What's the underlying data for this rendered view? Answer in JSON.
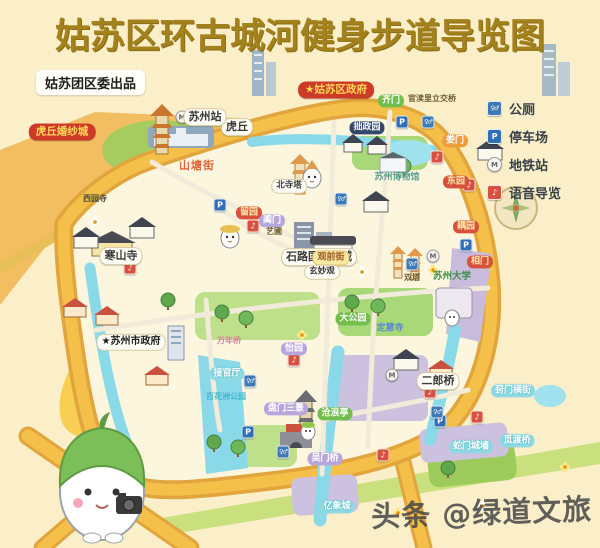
{
  "header": {
    "title": "姑苏区环古城河健身步道导览图",
    "byline": "姑苏团区委出品"
  },
  "legend": {
    "items": [
      {
        "type": "toilet",
        "glyph": "♀♂",
        "label": "公厕"
      },
      {
        "type": "parking",
        "glyph": "P",
        "label": "停车场"
      },
      {
        "type": "metro",
        "glyph": "M",
        "label": "地铁站"
      },
      {
        "type": "audio",
        "glyph": "♪",
        "label": "语音导览"
      }
    ]
  },
  "map": {
    "labels": [
      {
        "text": "虎丘",
        "x": 237,
        "y": 127,
        "type": "white"
      },
      {
        "text": "苏州站",
        "x": 205,
        "y": 117,
        "type": "white"
      },
      {
        "text": "虎丘婚纱城",
        "x": 62,
        "y": 132,
        "type": "redband"
      },
      {
        "text": "★姑苏区政府",
        "x": 336,
        "y": 90,
        "type": "redband"
      },
      {
        "text": "齐门",
        "x": 391,
        "y": 101,
        "type": "green"
      },
      {
        "text": "官渎里立交桥",
        "x": 432,
        "y": 99,
        "type": "tinytext"
      },
      {
        "text": "娄门",
        "x": 455,
        "y": 141,
        "type": "orange"
      },
      {
        "text": "拙政园",
        "x": 367,
        "y": 128,
        "type": "navy"
      },
      {
        "text": "苏州博物馆",
        "x": 397,
        "y": 178,
        "type": "teal-text"
      },
      {
        "text": "北寺塔",
        "x": 289,
        "y": 186,
        "type": "white-sm"
      },
      {
        "text": "山塘街",
        "x": 197,
        "y": 166,
        "type": "rainbow-text"
      },
      {
        "text": "留园",
        "x": 249,
        "y": 213,
        "type": "red"
      },
      {
        "text": "阊门",
        "x": 272,
        "y": 221,
        "type": "purple"
      },
      {
        "text": "艺圃",
        "x": 274,
        "y": 232,
        "type": "tinytext"
      },
      {
        "text": "西园寺",
        "x": 95,
        "y": 199,
        "type": "dark-text"
      },
      {
        "text": "石路国际商城",
        "x": 319,
        "y": 257,
        "type": "white"
      },
      {
        "text": "寒山寺",
        "x": 121,
        "y": 256,
        "type": "white"
      },
      {
        "text": "东园",
        "x": 456,
        "y": 182,
        "type": "red"
      },
      {
        "text": "耦园",
        "x": 466,
        "y": 227,
        "type": "red"
      },
      {
        "text": "相门",
        "x": 480,
        "y": 262,
        "type": "red"
      },
      {
        "text": "苏州大学",
        "x": 452,
        "y": 277,
        "type": "green-text"
      },
      {
        "text": "双塔",
        "x": 412,
        "y": 278,
        "type": "tinytext"
      },
      {
        "text": "观前街",
        "x": 331,
        "y": 258,
        "type": "yellow"
      },
      {
        "text": "玄妙观",
        "x": 322,
        "y": 272,
        "type": "white-sm"
      },
      {
        "text": "大公园",
        "x": 353,
        "y": 319,
        "type": "green"
      },
      {
        "text": "定慧寺",
        "x": 390,
        "y": 329,
        "type": "blue-text"
      },
      {
        "text": "怡园",
        "x": 294,
        "y": 349,
        "type": "purple"
      },
      {
        "text": "万年桥",
        "x": 229,
        "y": 341,
        "type": "pink-text"
      },
      {
        "text": "接官厅",
        "x": 227,
        "y": 374,
        "type": "cyan"
      },
      {
        "text": "百花洲公园",
        "x": 226,
        "y": 397,
        "type": "cyan-text"
      },
      {
        "text": "★苏州市政府",
        "x": 131,
        "y": 342,
        "type": "white-star"
      },
      {
        "text": "盘门三景",
        "x": 286,
        "y": 409,
        "type": "purple"
      },
      {
        "text": "沧浪亭",
        "x": 335,
        "y": 414,
        "type": "green"
      },
      {
        "text": "葑门横街",
        "x": 513,
        "y": 391,
        "type": "cyan"
      },
      {
        "text": "二郎桥",
        "x": 438,
        "y": 381,
        "type": "white"
      },
      {
        "text": "觅渡桥",
        "x": 517,
        "y": 441,
        "type": "cyan"
      },
      {
        "text": "蛇门城墙",
        "x": 471,
        "y": 447,
        "type": "cyan"
      },
      {
        "text": "吴门桥",
        "x": 325,
        "y": 459,
        "type": "purple"
      },
      {
        "text": "亿象城",
        "x": 337,
        "y": 507,
        "type": "cyan"
      }
    ],
    "markers": [
      {
        "type": "metro",
        "glyph": "M",
        "x": 182,
        "y": 117
      },
      {
        "type": "metro",
        "glyph": "M",
        "x": 433,
        "y": 256
      },
      {
        "type": "metro",
        "glyph": "M",
        "x": 392,
        "y": 375
      },
      {
        "type": "parking",
        "glyph": "P",
        "x": 220,
        "y": 205
      },
      {
        "type": "parking",
        "glyph": "P",
        "x": 466,
        "y": 245
      },
      {
        "type": "parking",
        "glyph": "P",
        "x": 248,
        "y": 432
      },
      {
        "type": "parking",
        "glyph": "P",
        "x": 440,
        "y": 421
      },
      {
        "type": "parking",
        "glyph": "P",
        "x": 402,
        "y": 122
      },
      {
        "type": "toilet",
        "glyph": "♀♂",
        "x": 341,
        "y": 199
      },
      {
        "type": "toilet",
        "glyph": "♀♂",
        "x": 428,
        "y": 122
      },
      {
        "type": "toilet",
        "glyph": "♀♂",
        "x": 412,
        "y": 264
      },
      {
        "type": "toilet",
        "glyph": "♀♂",
        "x": 283,
        "y": 452
      },
      {
        "type": "toilet",
        "glyph": "♀♂",
        "x": 437,
        "y": 412
      },
      {
        "type": "toilet",
        "glyph": "♀♂",
        "x": 250,
        "y": 381
      },
      {
        "type": "audio",
        "glyph": "♪",
        "x": 130,
        "y": 268
      },
      {
        "type": "audio",
        "glyph": "♪",
        "x": 253,
        "y": 226
      },
      {
        "type": "audio",
        "glyph": "♪",
        "x": 437,
        "y": 157
      },
      {
        "type": "audio",
        "glyph": "♪",
        "x": 469,
        "y": 185
      },
      {
        "type": "audio",
        "glyph": "♪",
        "x": 430,
        "y": 392
      },
      {
        "type": "audio",
        "glyph": "♪",
        "x": 477,
        "y": 417
      },
      {
        "type": "audio",
        "glyph": "♪",
        "x": 383,
        "y": 455
      },
      {
        "type": "audio",
        "glyph": "♪",
        "x": 294,
        "y": 360
      }
    ]
  },
  "watermark": {
    "text": "头条 @绿道文旅"
  },
  "colors": {
    "background": "#FBEFC9",
    "title": "#A3811C",
    "trail_ring": "#F4C049",
    "water": "#89D9E8",
    "park_green": "#A9D878",
    "label_red": "#CE3A28",
    "label_purple": "#B7A6DB",
    "label_cyan": "#8FD9E3"
  }
}
